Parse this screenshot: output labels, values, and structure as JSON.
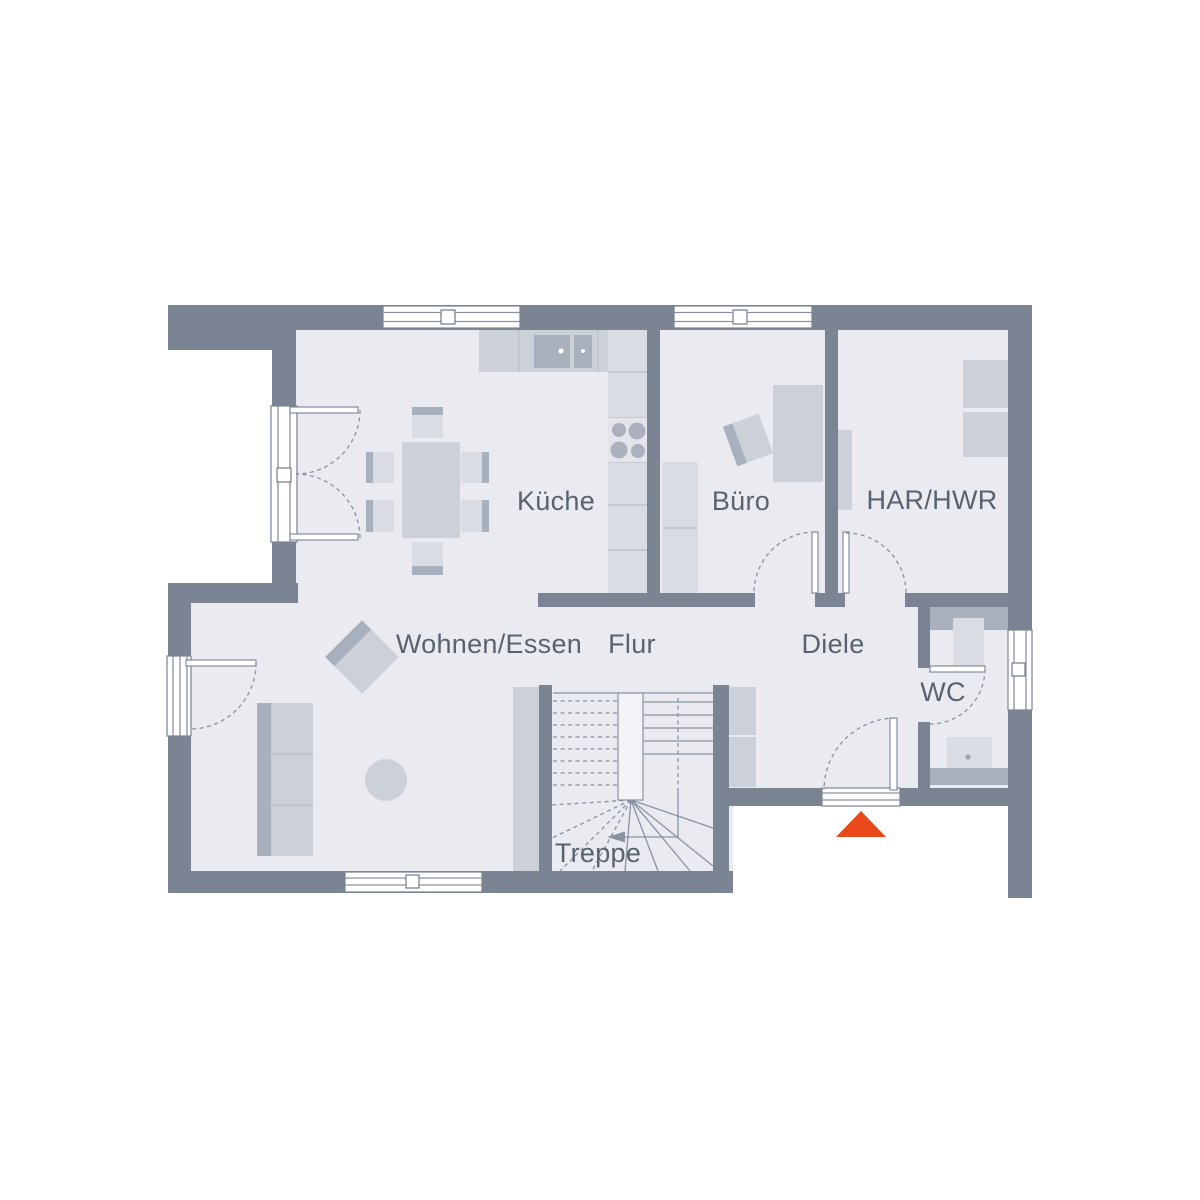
{
  "rooms": [
    {
      "id": "kueche",
      "label": "Küche"
    },
    {
      "id": "buero",
      "label": "Büro"
    },
    {
      "id": "har-hwr",
      "label": "HAR/HWR"
    },
    {
      "id": "wohnen-essen",
      "label": "Wohnen/Essen"
    },
    {
      "id": "flur",
      "label": "Flur"
    },
    {
      "id": "diele",
      "label": "Diele"
    },
    {
      "id": "wc",
      "label": "WC"
    },
    {
      "id": "treppe",
      "label": "Treppe"
    }
  ],
  "entrance": {
    "marker": "entrance-triangle",
    "color": "#e8481a"
  },
  "colors": {
    "background": "#ffffff",
    "wall": "#7a8493",
    "floor": "#e9ebf0",
    "furniture_medium": "#ccd1d9",
    "furniture_dark": "#a9b0bd",
    "furniture_light": "#d9dce2",
    "line": "#8a92a1",
    "text": "#5a6270"
  }
}
